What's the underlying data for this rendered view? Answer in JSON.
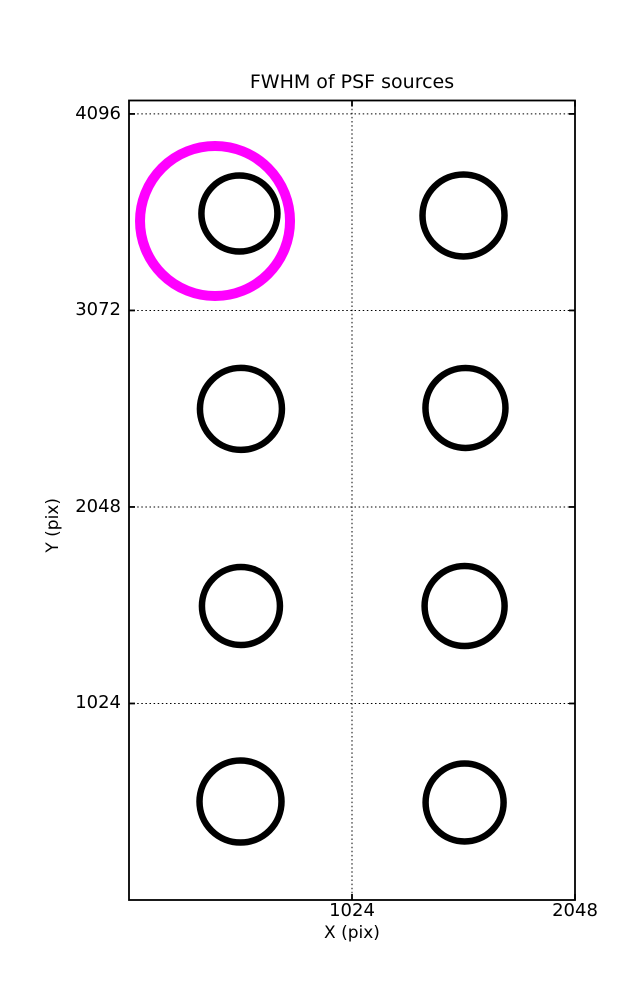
{
  "chart_data": {
    "type": "scatter",
    "title": "FWHM of PSF sources",
    "xlabel": "X (pix)",
    "ylabel": "Y (pix)",
    "xlim": [
      0,
      2048
    ],
    "ylim": [
      0,
      4166
    ],
    "x_axis": {
      "label": "X (pix)",
      "ticks": [
        {
          "value": 1024,
          "label": "1024"
        },
        {
          "value": 2048,
          "label": "2048"
        }
      ]
    },
    "y_axis": {
      "label": "Y (pix)",
      "ticks": [
        {
          "value": 1024,
          "label": "1024"
        },
        {
          "value": 2048,
          "label": "2048"
        },
        {
          "value": 3072,
          "label": "3072"
        },
        {
          "value": 4096,
          "label": "4096"
        }
      ]
    },
    "grid": {
      "on": true,
      "style": "dotted",
      "color": "#000000",
      "x_gridlines": [
        1024
      ],
      "y_gridlines": [
        1024,
        2048,
        3072,
        4096
      ]
    },
    "axes_style": {
      "spine_color": "#000000",
      "spine_width_px": 1.8,
      "tick_direction": "in",
      "tick_length_px": 6,
      "background": "#ffffff"
    },
    "series": [
      {
        "name": "psf_sources",
        "marker": "open-circle",
        "color": "#000000",
        "stroke_width_px": 6.5,
        "points": [
          {
            "x": 507,
            "y": 3577,
            "r_px": 38
          },
          {
            "x": 1536,
            "y": 3567,
            "r_px": 41
          },
          {
            "x": 514,
            "y": 2559,
            "r_px": 41
          },
          {
            "x": 1545,
            "y": 2564,
            "r_px": 40
          },
          {
            "x": 514,
            "y": 1532,
            "r_px": 39
          },
          {
            "x": 1541,
            "y": 1532,
            "r_px": 40
          },
          {
            "x": 512,
            "y": 513,
            "r_px": 41
          },
          {
            "x": 1541,
            "y": 508,
            "r_px": 39
          }
        ]
      },
      {
        "name": "flagged_source",
        "marker": "open-circle",
        "color": "#FF00FF",
        "stroke_width_px": 10,
        "points": [
          {
            "x": 395,
            "y": 3538,
            "r_px": 75
          }
        ]
      }
    ]
  }
}
